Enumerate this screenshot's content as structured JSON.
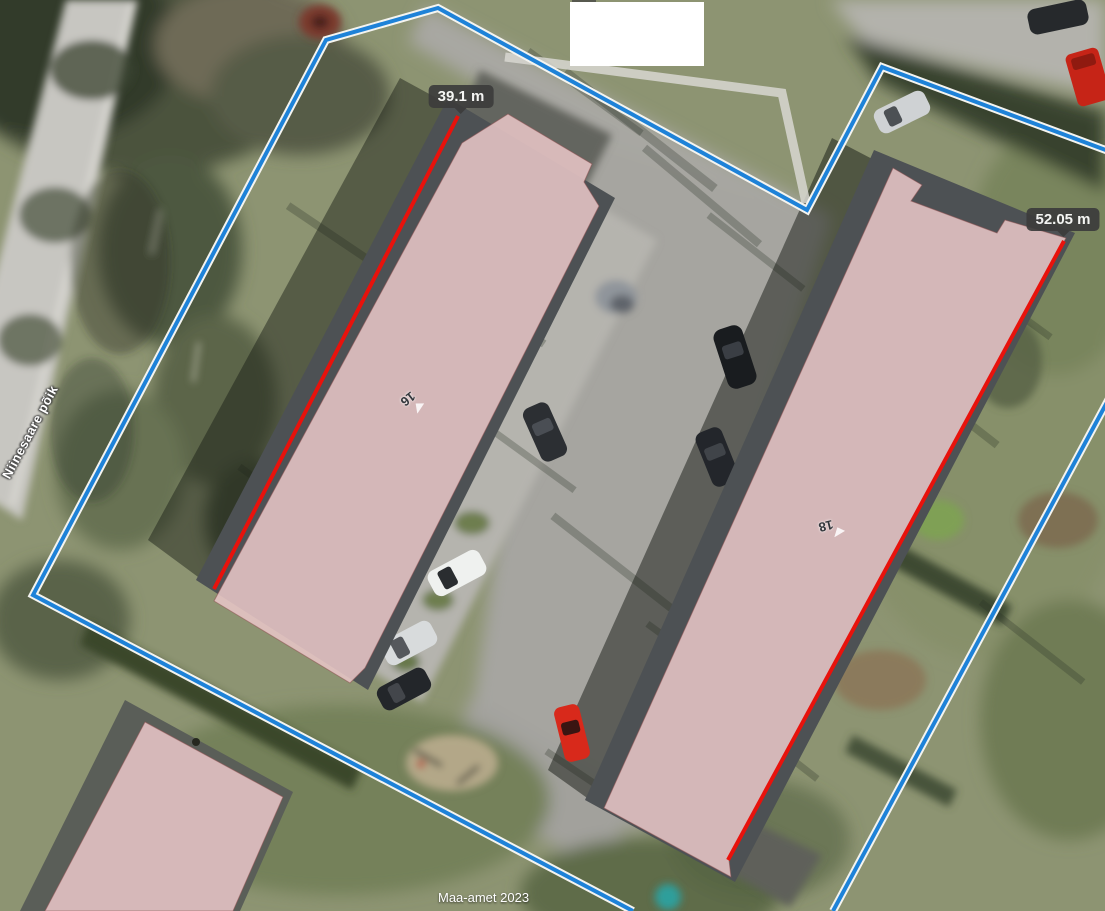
{
  "map": {
    "attribution": "Maa-amet 2023",
    "street_label": "Niinesaare põik",
    "buildings": [
      {
        "number": "16",
        "edge_length": "39.1 m"
      },
      {
        "number": "18",
        "edge_length": "52.05 m"
      }
    ],
    "legend": {
      "boundary_line": "cadastral parcel boundary",
      "red_line": "measured building edge"
    },
    "colors": {
      "boundary": "#1e82d8",
      "measurement": "#e8120c",
      "building_overlay": "#e7c5c6",
      "badge_background": "#3c3c3c",
      "badge_text": "#ffffff"
    }
  }
}
